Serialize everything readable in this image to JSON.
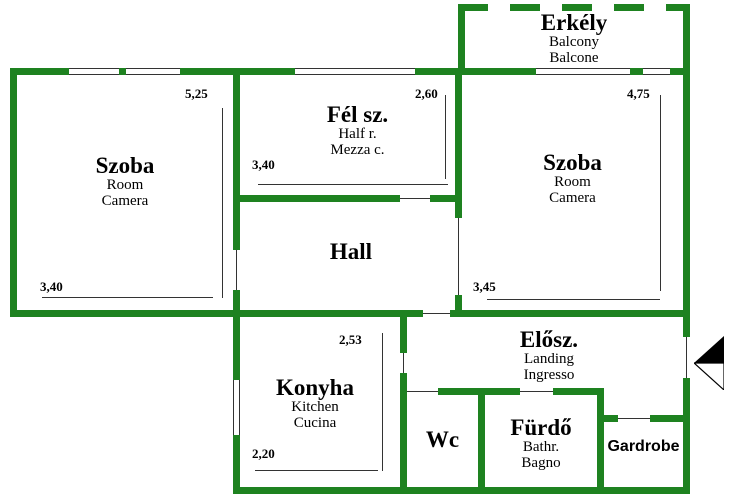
{
  "colors": {
    "wall": "#1e8220",
    "line": "#333333",
    "text": "#000000",
    "bg": "#ffffff"
  },
  "rooms": {
    "balcony": {
      "title": "Erkély",
      "sub1": "Balcony",
      "sub2": "Balcone"
    },
    "room_left": {
      "title": "Szoba",
      "sub1": "Room",
      "sub2": "Camera"
    },
    "half_room": {
      "title": "Fél sz.",
      "sub1": "Half r.",
      "sub2": "Mezza c."
    },
    "hall": {
      "title": "Hall"
    },
    "room_right": {
      "title": "Szoba",
      "sub1": "Room",
      "sub2": "Camera"
    },
    "kitchen": {
      "title": "Konyha",
      "sub1": "Kitchen",
      "sub2": "Cucina"
    },
    "landing": {
      "title": "Elősz.",
      "sub1": "Landing",
      "sub2": "Ingresso"
    },
    "wc": {
      "title": "Wc"
    },
    "bathroom": {
      "title": "Fürdő",
      "sub1": "Bathr.",
      "sub2": "Bagno"
    },
    "wardrobe": {
      "title": "Gardrobe"
    }
  },
  "dimensions": {
    "room_left_height": "5,25",
    "room_left_width": "3,40",
    "half_room_height": "2,60",
    "half_room_width": "3,40",
    "room_right_height": "4,75",
    "room_right_width": "3,45",
    "kitchen_height": "2,53",
    "kitchen_width": "2,20"
  },
  "icons": {
    "entrance_arrow": "entrance-arrow"
  }
}
